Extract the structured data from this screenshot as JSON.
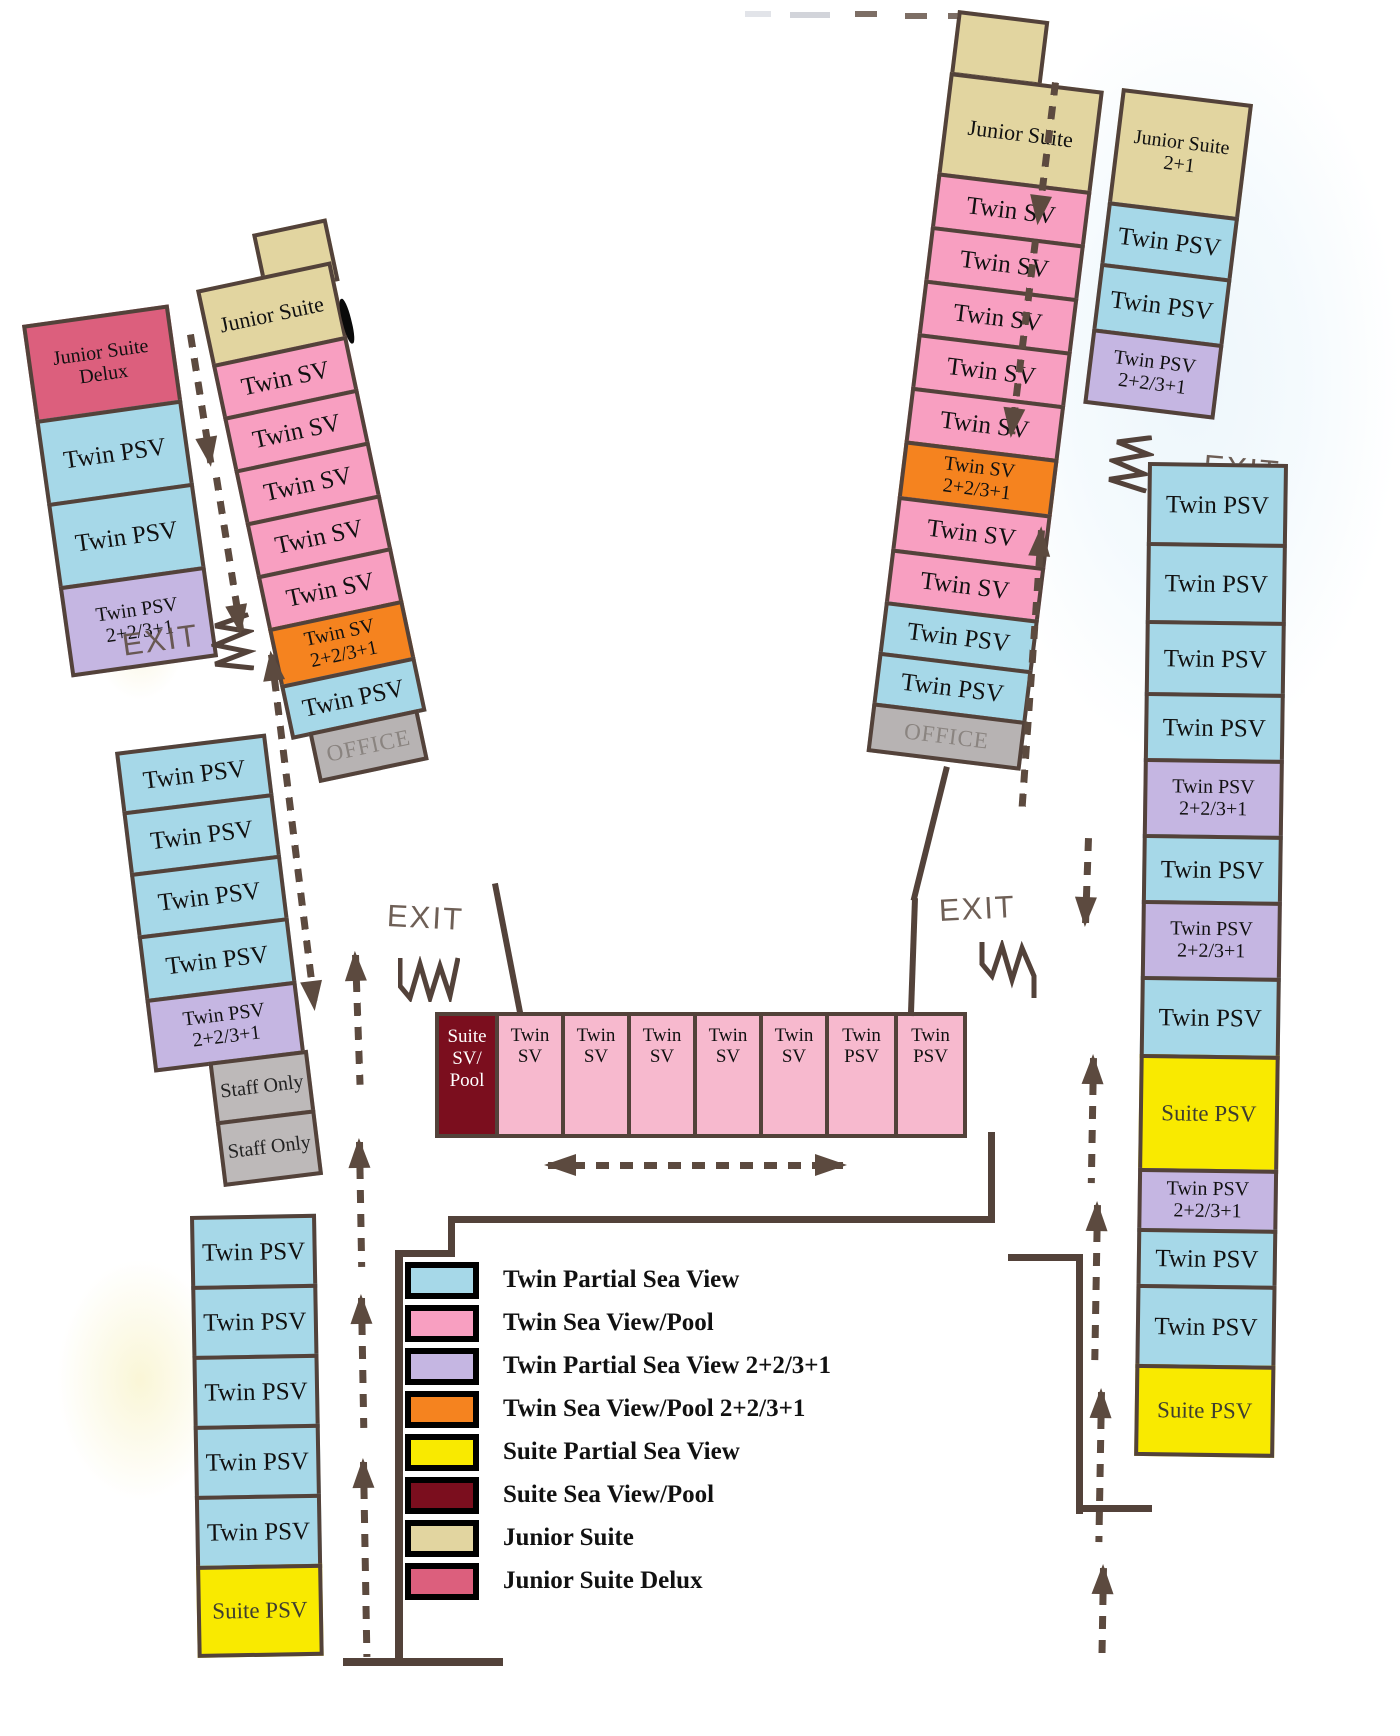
{
  "colors": {
    "twin_psv": "#A6D8E8",
    "twin_sv": "#F89FC1",
    "twin_sv_light": "#F7B9CE",
    "twin_psv_plus": "#C5B6E2",
    "twin_sv_plus": "#F5831F",
    "suite_psv": "#F9EA00",
    "suite_sv_pool": "#7B0E1E",
    "junior_suite": "#E2D5A0",
    "junior_suite_delux": "#DC5F7D",
    "office": "#B7B3B3",
    "staff": "#BDB9B9",
    "wall": "#53423A"
  },
  "labels": {
    "exit": "EXIT"
  },
  "left_wing": {
    "outer_top": [
      {
        "lines": [
          "Junior Suite",
          "Delux"
        ],
        "type": "junior_suite_delux",
        "h": 100
      },
      {
        "label": "Twin PSV",
        "type": "twin_psv",
        "h": 88
      },
      {
        "label": "Twin PSV",
        "type": "twin_psv",
        "h": 88
      },
      {
        "lines": [
          "Twin PSV",
          "2+2/3+1"
        ],
        "type": "twin_psv_plus",
        "h": 92
      }
    ],
    "outer_mid": [
      {
        "label": "Twin PSV",
        "type": "twin_psv",
        "h": 64
      },
      {
        "label": "Twin PSV",
        "type": "twin_psv",
        "h": 66
      },
      {
        "label": "Twin PSV",
        "type": "twin_psv",
        "h": 67
      },
      {
        "label": "Twin PSV",
        "type": "twin_psv",
        "h": 68
      },
      {
        "lines": [
          "Twin PSV",
          "2+2/3+1"
        ],
        "type": "twin_psv_plus",
        "h": 74
      },
      {
        "label": "Staff Only",
        "type": "staff",
        "h": 64,
        "w": 100,
        "indent": 55
      },
      {
        "label": "Staff Only",
        "type": "staff",
        "h": 66,
        "w": 100,
        "indent": 55
      }
    ],
    "bottom": [
      {
        "label": "Twin PSV",
        "type": "twin_psv",
        "h": 74
      },
      {
        "label": "Twin PSV",
        "type": "twin_psv",
        "h": 74
      },
      {
        "label": "Twin PSV",
        "type": "twin_psv",
        "h": 74
      },
      {
        "label": "Twin PSV",
        "type": "twin_psv",
        "h": 74
      },
      {
        "label": "Twin PSV",
        "type": "twin_psv",
        "h": 74
      },
      {
        "label": "Suite PSV",
        "type": "suite_psv",
        "h": 92
      }
    ],
    "inner": [
      {
        "label": "Junior Suite",
        "type": "junior_suite",
        "h": 80
      },
      {
        "label": "Twin SV",
        "type": "twin_sv",
        "h": 58
      },
      {
        "label": "Twin SV",
        "type": "twin_sv",
        "h": 58
      },
      {
        "label": "Twin SV",
        "type": "twin_sv",
        "h": 58
      },
      {
        "label": "Twin SV",
        "type": "twin_sv",
        "h": 58
      },
      {
        "label": "Twin SV",
        "type": "twin_sv",
        "h": 58
      },
      {
        "lines": [
          "Twin SV",
          "2+2/3+1"
        ],
        "type": "twin_sv_plus",
        "h": 62
      },
      {
        "label": "Twin PSV",
        "type": "twin_psv",
        "h": 56
      },
      {
        "label": "OFFICE",
        "type": "office",
        "h": 52,
        "w": 112,
        "indent": 18
      }
    ]
  },
  "middle_row": [
    {
      "lines": [
        "Suite",
        "SV/",
        "Pool"
      ],
      "type": "suite_sv_pool",
      "w": 64
    },
    {
      "lines": [
        "Twin",
        "SV"
      ],
      "type": "twin_sv_light",
      "w": 70
    },
    {
      "lines": [
        "Twin",
        "SV"
      ],
      "type": "twin_sv_light",
      "w": 70
    },
    {
      "lines": [
        "Twin",
        "SV"
      ],
      "type": "twin_sv_light",
      "w": 70
    },
    {
      "lines": [
        "Twin",
        "SV"
      ],
      "type": "twin_sv_light",
      "w": 70
    },
    {
      "lines": [
        "Twin",
        "SV"
      ],
      "type": "twin_sv_light",
      "w": 70
    },
    {
      "lines": [
        "Twin",
        "PSV"
      ],
      "type": "twin_sv_light",
      "w": 73
    },
    {
      "lines": [
        "Twin",
        "PSV"
      ],
      "type": "twin_sv_light",
      "w": 73
    }
  ],
  "right_wing": {
    "outer": [
      {
        "label": "Junior Suite",
        "type": "junior_suite",
        "h": 105
      },
      {
        "label": "Twin SV",
        "type": "twin_sv",
        "h": 58
      },
      {
        "label": "Twin SV",
        "type": "twin_sv",
        "h": 58
      },
      {
        "label": "Twin SV",
        "type": "twin_sv",
        "h": 58
      },
      {
        "label": "Twin SV",
        "type": "twin_sv",
        "h": 58
      },
      {
        "label": "Twin SV",
        "type": "twin_sv",
        "h": 58
      },
      {
        "lines": [
          "Twin SV",
          "2+2/3+1"
        ],
        "type": "twin_sv_plus",
        "h": 60
      },
      {
        "label": "Twin SV",
        "type": "twin_sv",
        "h": 57
      },
      {
        "label": "Twin SV",
        "type": "twin_sv",
        "h": 57
      },
      {
        "label": "Twin PSV",
        "type": "twin_psv",
        "h": 55
      },
      {
        "label": "Twin PSV",
        "type": "twin_psv",
        "h": 55
      },
      {
        "label": "OFFICE",
        "type": "office",
        "h": 50
      }
    ],
    "inner_top": [
      {
        "lines": [
          "Junior Suite",
          "2+1"
        ],
        "type": "junior_suite",
        "h": 118
      },
      {
        "label": "Twin PSV",
        "type": "twin_psv",
        "h": 66
      },
      {
        "label": "Twin PSV",
        "type": "twin_psv",
        "h": 70
      },
      {
        "lines": [
          "Twin PSV",
          "2+2/3+1"
        ],
        "type": "twin_psv_plus",
        "h": 76
      }
    ],
    "inner_bottom": [
      {
        "label": "Twin PSV",
        "type": "twin_psv",
        "h": 84
      },
      {
        "label": "Twin PSV",
        "type": "twin_psv",
        "h": 82
      },
      {
        "label": "Twin PSV",
        "type": "twin_psv",
        "h": 76
      },
      {
        "label": "Twin PSV",
        "type": "twin_psv",
        "h": 70
      },
      {
        "lines": [
          "Twin PSV",
          "2+2/3+1"
        ],
        "type": "twin_psv_plus",
        "h": 80
      },
      {
        "label": "Twin PSV",
        "type": "twin_psv",
        "h": 70
      },
      {
        "lines": [
          "Twin PSV",
          "2+2/3+1"
        ],
        "type": "twin_psv_plus",
        "h": 80
      },
      {
        "label": "Twin PSV",
        "type": "twin_psv",
        "h": 82
      },
      {
        "label": "Suite PSV",
        "type": "suite_psv",
        "h": 118
      },
      {
        "lines": [
          "Twin PSV",
          "2+2/3+1"
        ],
        "type": "twin_psv_plus",
        "h": 64
      },
      {
        "label": "Twin PSV",
        "type": "twin_psv",
        "h": 60
      },
      {
        "label": "Twin PSV",
        "type": "twin_psv",
        "h": 84
      },
      {
        "label": "Suite PSV",
        "type": "suite_psv",
        "h": 92
      }
    ]
  },
  "legend": {
    "items": [
      {
        "label": "Twin Partial Sea View",
        "type": "twin_psv"
      },
      {
        "label": "Twin Sea View/Pool",
        "type": "twin_sv"
      },
      {
        "label": "Twin Partial Sea View 2+2/3+1",
        "type": "twin_psv_plus"
      },
      {
        "label": "Twin Sea View/Pool 2+2/3+1",
        "type": "twin_sv_plus"
      },
      {
        "label": "Suite Partial Sea View",
        "type": "suite_psv"
      },
      {
        "label": "Suite Sea View/Pool",
        "type": "suite_sv_pool"
      },
      {
        "label": "Junior Suite",
        "type": "junior_suite"
      },
      {
        "label": "Junior Suite Delux",
        "type": "junior_suite_delux"
      }
    ]
  }
}
